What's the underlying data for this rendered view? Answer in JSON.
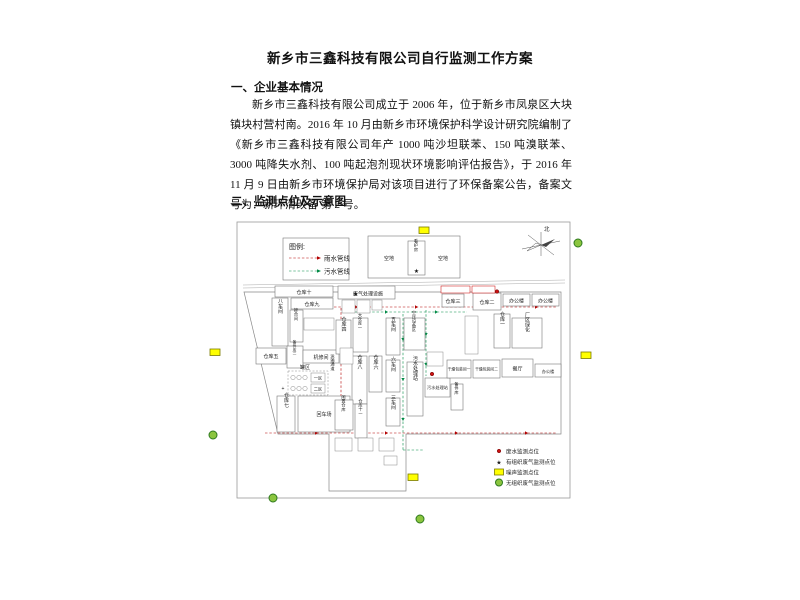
{
  "doc": {
    "title": "新乡市三鑫科技有限公司自行监测工作方案",
    "section1_heading": "一、企业基本情况",
    "paragraph": "新乡市三鑫科技有限公司成立于 2006 年，位于新乡市凤泉区大块镇块村营村南。2016 年 10 月由新乡市环境保护科学设计研究院编制了《新乡市三鑫科技有限公司年产 1000 吨沙坦联苯、150 吨溴联苯、3000 吨降失水剂、100 吨起泡剂现状环境影响评估报告》，于 2016 年 11 月 9 日由新乡市环境保护局对该项目进行了环保备案公告，备案文号为：新环清改备 第 2 号。",
    "section2_heading": "二、监测点位及示意图"
  },
  "diagram": {
    "pipe_legend": {
      "title": "图例:",
      "rain": "雨水管线",
      "sewage": "污水管线"
    },
    "open_area_left": "空地",
    "open_area_right": "空地",
    "guard_house": "看护房",
    "compass_north": "北",
    "symbols": {
      "star": "★",
      "plus": "+"
    },
    "buildings": [
      "仓库十",
      "仓库九",
      "八车间",
      "掺合间",
      "备件库二",
      "仓库五",
      "机修间",
      "罐区",
      "一区",
      "二区",
      "仓库七",
      "回车场",
      "运输通道",
      "仓库八",
      "仓库六",
      "废气处理设施",
      "仓库四",
      "大仓库一",
      "五车间",
      "六车间",
      "三车间",
      "空压设备区",
      "污水处理站",
      "污水处理站",
      "备件库",
      "闲置仓库",
      "仓库十一",
      "仓库三",
      "仓库二",
      "办公楼",
      "办公楼",
      "仓库一",
      "厂区绿化",
      "干燥包装间一",
      "干燥包装间二",
      "餐厅",
      "办公楼"
    ],
    "point_legend": [
      "废水监测点位",
      "有组织废气监测点位",
      "噪声监测点位",
      "无组织废气监测点位"
    ],
    "colors": {
      "rain_pipe": "#b30000",
      "sewage_pipe": "#008a45",
      "noise_marker": "#ffff00",
      "unorganized_gas_marker": "#8bc53f",
      "wastewater_marker": "#cc0000"
    }
  }
}
